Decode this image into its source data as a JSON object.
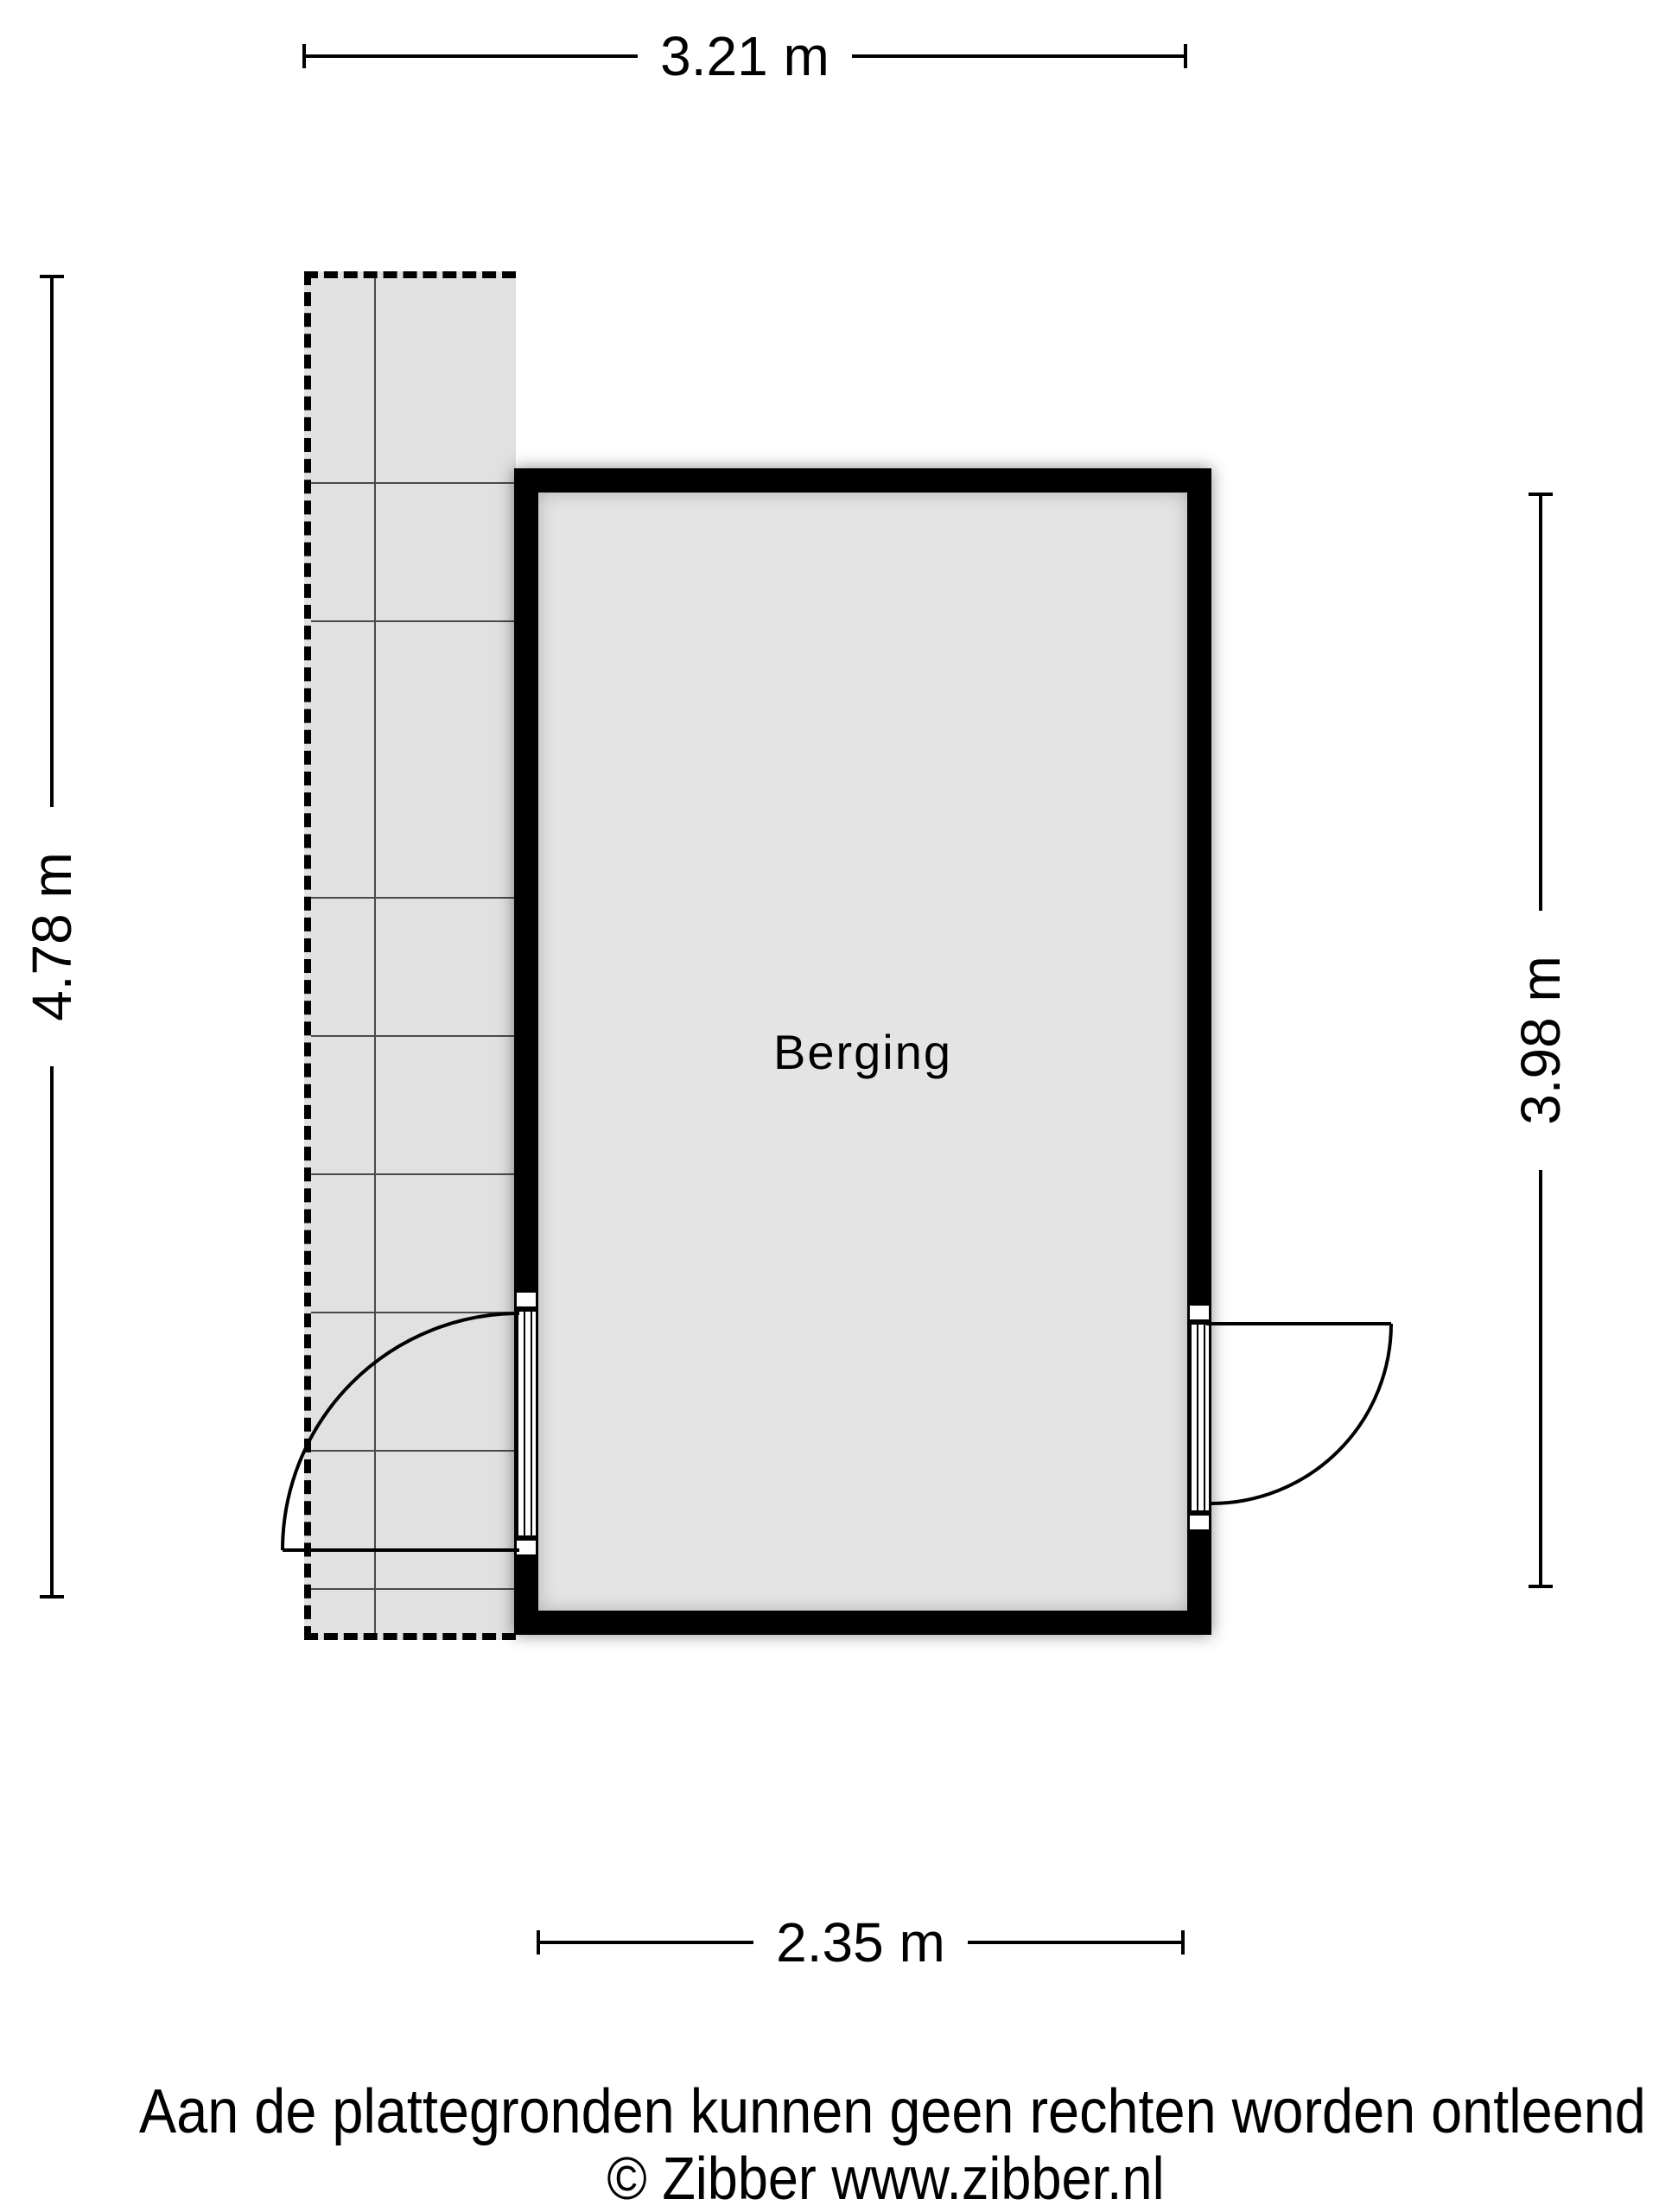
{
  "floorplan": {
    "room": {
      "label": "Berging"
    },
    "dimensions": {
      "top": "3.21 m",
      "left": "4.78 m",
      "right": "3.98 m",
      "bottom": "2.35 m"
    },
    "colors": {
      "wall": "#000000",
      "floor": "#e4e4e4",
      "terrace": "#e1e1e1",
      "line": "#000000",
      "background": "#ffffff"
    }
  },
  "footer": {
    "disclaimer": "Aan de plattegronden kunnen geen rechten worden ontleend",
    "copyright": "© Zibber www.zibber.nl"
  }
}
